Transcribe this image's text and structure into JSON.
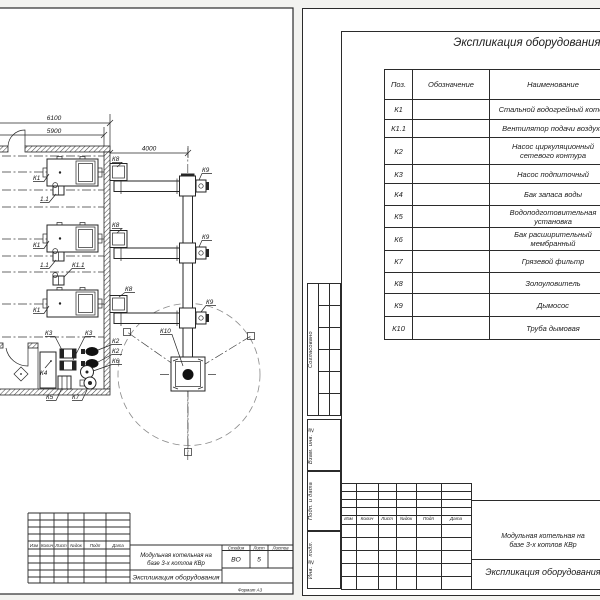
{
  "colors": {
    "line": "#262626",
    "paper": "#ffffff",
    "background": "#f3f3f0"
  },
  "left_sheet": {
    "dims": {
      "d6100": "6100",
      "d5900": "5900",
      "d4000": "4000"
    },
    "labels": {
      "k1": "К1",
      "k1_1": "К1.1",
      "fan": "1.1",
      "k2": "К2",
      "k3": "К3",
      "k4": "К4",
      "k5": "К5",
      "k6": "К6",
      "k7": "К7",
      "k8": "К8",
      "k9": "К9",
      "k10": "К10"
    },
    "title_block": {
      "rev_headers": [
        "Изм",
        "Колич",
        "Лист",
        "№док",
        "Подп",
        "Дата"
      ],
      "project_line1": "Модульная котельная на",
      "project_line2": "базе 3-х котлов КВр",
      "doc_title": "Экспликация оборудования",
      "stage_label": "Стадия",
      "sheet_label": "Лист",
      "sheets_label": "Листов",
      "stage_value": "ВО",
      "sheet_value": "5",
      "sheets_value": "",
      "format_note": "Формат  А3"
    }
  },
  "right_sheet": {
    "title": "Экспликация оборудования",
    "table": {
      "columns": [
        "Поз.",
        "Обозначение",
        "Наименование"
      ],
      "rows": [
        {
          "pos": "К1",
          "designation": "",
          "name": "Стальной водогрейный котел"
        },
        {
          "pos": "К1.1",
          "designation": "",
          "name": "Вентилятор подачи воздуха"
        },
        {
          "pos": "К2",
          "designation": "",
          "name": "Насос циркуляционный сетевого контура"
        },
        {
          "pos": "К3",
          "designation": "",
          "name": "Насос подпиточный"
        },
        {
          "pos": "К4",
          "designation": "",
          "name": "Бак запаса воды"
        },
        {
          "pos": "К5",
          "designation": "",
          "name": "Водоподготовительная установка"
        },
        {
          "pos": "К6",
          "designation": "",
          "name": "Бак расширительный мембранный"
        },
        {
          "pos": "К7",
          "designation": "",
          "name": "Грязевой фильтр"
        },
        {
          "pos": "К8",
          "designation": "",
          "name": "Золоуловитель"
        },
        {
          "pos": "К9",
          "designation": "",
          "name": "Дымосос"
        },
        {
          "pos": "К10",
          "designation": "",
          "name": "Труба дымовая"
        }
      ]
    },
    "margin_labels": {
      "approved": "Согласовано",
      "replace": "Взам. инв. №",
      "sign_date": "Подп. и дата",
      "inv_orig": "Инв. № подл."
    },
    "title_block": {
      "rev_headers": [
        "Изм",
        "Колич",
        "Лист",
        "№док",
        "Подп",
        "Дата"
      ],
      "project_line1": "Модульная котельная на",
      "project_line2": "базе 3-х котлов КВр",
      "doc_title": "Экспликация оборудования"
    }
  }
}
